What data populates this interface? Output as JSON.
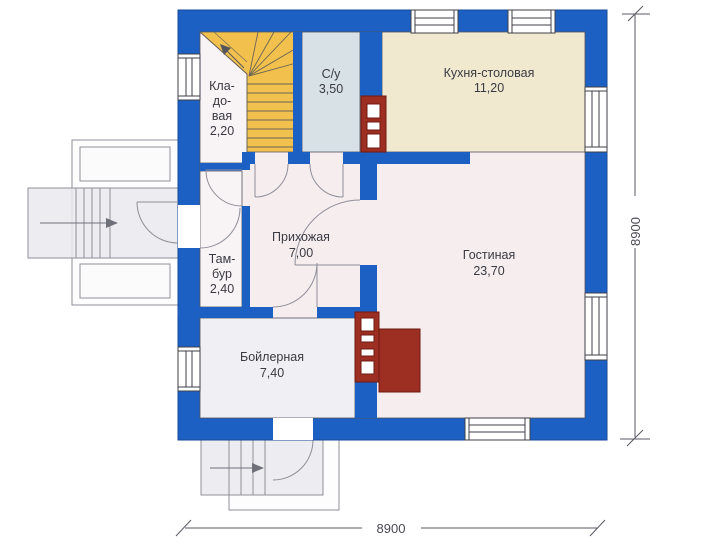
{
  "plan_title": "first-floor-plan",
  "rooms": {
    "storage": {
      "name_lines": [
        "Кла-",
        "до-",
        "вая"
      ],
      "area": "2,20"
    },
    "bathroom": {
      "name": "С/у",
      "area": "3,50"
    },
    "kitchen": {
      "name": "Кухня-столовая",
      "area": "11,20"
    },
    "hallway": {
      "name": "Прихожая",
      "area": "7,00"
    },
    "living": {
      "name": "Гостиная",
      "area": "23,70"
    },
    "vestibule": {
      "name_lines": [
        "Там-",
        "бур"
      ],
      "area": "2,40"
    },
    "boiler": {
      "name": "Бойлерная",
      "area": "7,40"
    }
  },
  "dimensions": {
    "bottom_label": "8900",
    "right_label": "8900"
  },
  "colors": {
    "wall_blue": "#1d60c4",
    "stair_yellow": "#f2c14d",
    "bathroom_fill": "#d7e1e6",
    "kitchen_fill": "#f0e9cf",
    "living_fill": "#f6edef",
    "boiler_fill": "#f0eff3",
    "white_room_fill": "#f8f4f6",
    "chimney_red": "#9c2f22",
    "line_gray": "#8f8f98"
  }
}
